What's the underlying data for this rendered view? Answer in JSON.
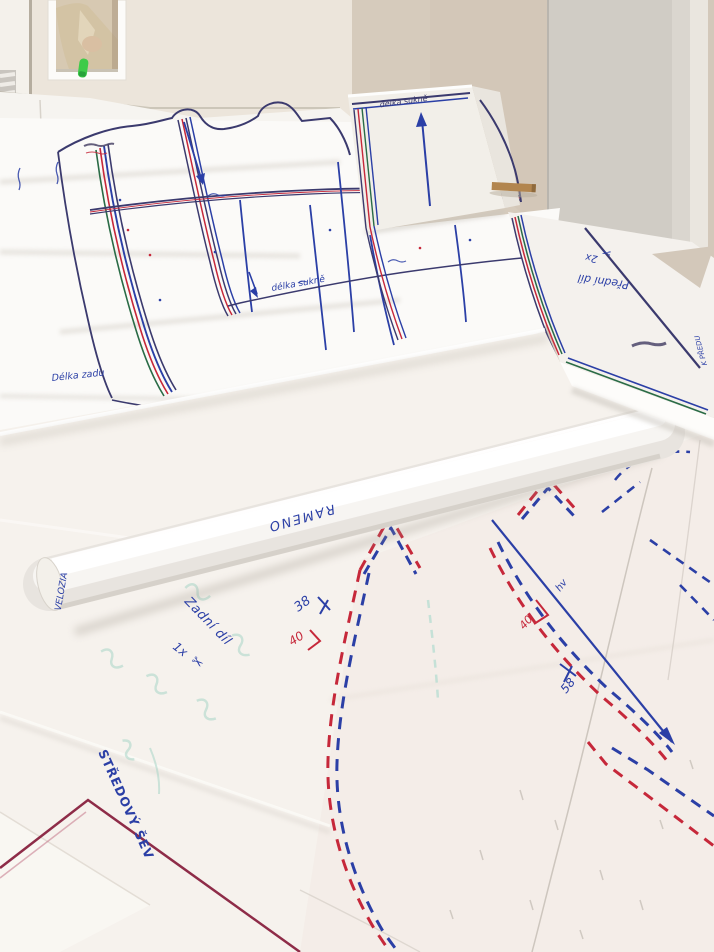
{
  "labels": {
    "flap_length": "délka sukně",
    "hem_length": "délka sukně",
    "back_length": "Délka zadu",
    "front_piece": "Přední díl",
    "front_piece_qty": "2x",
    "to_front": "K PŘEDU",
    "roll_word": "RAMENO",
    "roll_end_word": "VELOZIA",
    "back_piece": "Zadní díl",
    "back_piece_qty": "1x",
    "center_seam": "STŘEDOVÝ ŠEV",
    "size_38": "38",
    "size_40": "40",
    "size_40_b": "40",
    "size_58": "58",
    "notch_mark": "hv"
  },
  "icons": {
    "scissors": "✂"
  },
  "colors": {
    "ink_blue": "#2b3fa6",
    "ink_red": "#c6283a",
    "ink_green": "#2a6b46",
    "ink_navy": "#3b3a6e",
    "ink_maroon": "#8e2c48",
    "ink_teal": "#a9d6c8",
    "sticker_green": "#3ecb49",
    "wall_beige": "#d6cbbc",
    "door_gray": "#d0ccc5",
    "paper_white": "#fbfaf8"
  }
}
